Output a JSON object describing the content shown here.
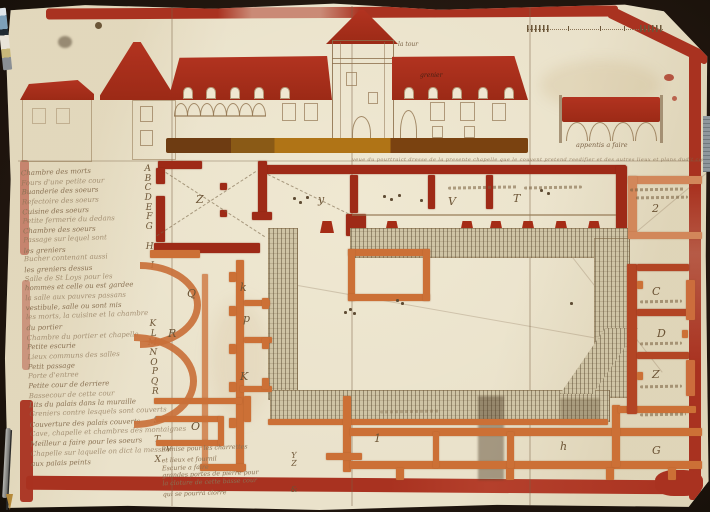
{
  "elevation": {
    "tower_label": "la tour",
    "roof_label": "grenier",
    "arcade_caption": "appentis a faire",
    "caption_line": "veue du pourtraict dresse de la presente chapelle que le couvent pretend reedifier et des autres lieux et plans dudit couvent"
  },
  "legend": {
    "items": [
      {
        "text": "Chambre des morts",
        "ref": "A"
      },
      {
        "text": "Fours d'une petite cour",
        "ref": "B"
      },
      {
        "text": "Buanderie des soeurs",
        "ref": "C"
      },
      {
        "text": "Refectoire des soeurs",
        "ref": "D"
      },
      {
        "text": "Cuisine des soeurs",
        "ref": "E"
      },
      {
        "text": "Petite fermerie du dedans",
        "ref": "F"
      },
      {
        "text": "Chambre des soeurs",
        "ref": "G"
      },
      {
        "text": "Passage sur lequel sont",
        "ref": ""
      },
      {
        "text": "les greniers",
        "ref": "H"
      },
      {
        "text": "Bucher contenant aussi",
        "ref": ""
      },
      {
        "text": "les greniers dessus",
        "ref": "I"
      },
      {
        "text": "Salle de St Loys pour les",
        "ref": ""
      },
      {
        "text": "hommes et celle ou est gardee",
        "ref": ""
      },
      {
        "text": "la salle aux pauvres passans",
        "ref": ""
      },
      {
        "text": "vestibule, salle ou sont mis",
        "ref": ""
      },
      {
        "text": "les morts, la cuisine et la chambre",
        "ref": ""
      },
      {
        "text": "du portier",
        "ref": "K"
      },
      {
        "text": "Chambre du portier et chapelle",
        "ref": "L"
      },
      {
        "text": "Petite escurie",
        "ref": "M"
      },
      {
        "text": "Lieux communs des salles",
        "ref": "N"
      },
      {
        "text": "Petit passage",
        "ref": "O"
      },
      {
        "text": "Porte d'entree",
        "ref": "P"
      },
      {
        "text": "Petite cour de derriere",
        "ref": "Q"
      },
      {
        "text": "Bassecour de cette cour",
        "ref": "R"
      },
      {
        "text": "Lits du palais dans la muraille",
        "ref": ""
      },
      {
        "text": "Greniers contre lesquels sont couverts",
        "ref": ""
      },
      {
        "text": "Couverture des palais couverts",
        "ref": "S"
      },
      {
        "text": "Cave, chapelle et chambres des montaignes",
        "ref": ""
      },
      {
        "text": "Meilleur a faire pour les soeurs",
        "ref": "T"
      },
      {
        "text": "Chapelle sur laquelle on dict la messe",
        "ref": "V"
      },
      {
        "text": "aux palais peints",
        "ref": "X"
      }
    ]
  },
  "plan": {
    "room_letters": [
      {
        "ch": "Z",
        "x": 196,
        "y": 193
      },
      {
        "ch": "y",
        "x": 318,
        "y": 193
      },
      {
        "ch": "V",
        "x": 448,
        "y": 195
      },
      {
        "ch": "T",
        "x": 513,
        "y": 192
      },
      {
        "ch": "2",
        "x": 652,
        "y": 202
      },
      {
        "ch": "k",
        "x": 240,
        "y": 281
      },
      {
        "ch": "Q",
        "x": 187,
        "y": 287
      },
      {
        "ch": "p",
        "x": 243,
        "y": 312
      },
      {
        "ch": "R",
        "x": 168,
        "y": 327
      },
      {
        "ch": "K",
        "x": 240,
        "y": 370
      },
      {
        "ch": "O",
        "x": 191,
        "y": 420
      },
      {
        "ch": "1",
        "x": 374,
        "y": 432
      },
      {
        "ch": "h",
        "x": 560,
        "y": 440
      },
      {
        "ch": "G",
        "x": 652,
        "y": 444
      },
      {
        "ch": "C",
        "x": 652,
        "y": 285
      },
      {
        "ch": "D",
        "x": 657,
        "y": 327
      },
      {
        "ch": "Z",
        "x": 652,
        "y": 368
      }
    ]
  },
  "notes": {
    "bottom_left": [
      {
        "text": "Remise pour les charrettes",
        "ref": ""
      },
      {
        "text": "et lieux et fournil",
        "ref": "Y"
      },
      {
        "text": "Escurie a faire",
        "ref": "Z"
      },
      {
        "text": "grandes portes de pierre pour",
        "ref": ""
      },
      {
        "text": "la cloture de cette basse cour",
        "ref": ""
      },
      {
        "text": "qui se pourra clorre",
        "ref": "&"
      }
    ]
  },
  "colors": {
    "paper": "#eae2cb",
    "border_red": "#a93220",
    "roof_red": "#ab2d18",
    "wall_red": "#9e2a17",
    "wall_orange": "#cc7036",
    "hatch_base": "#cfc4a5",
    "ink": "#8a7254",
    "ground_ochre": "#b07416"
  }
}
